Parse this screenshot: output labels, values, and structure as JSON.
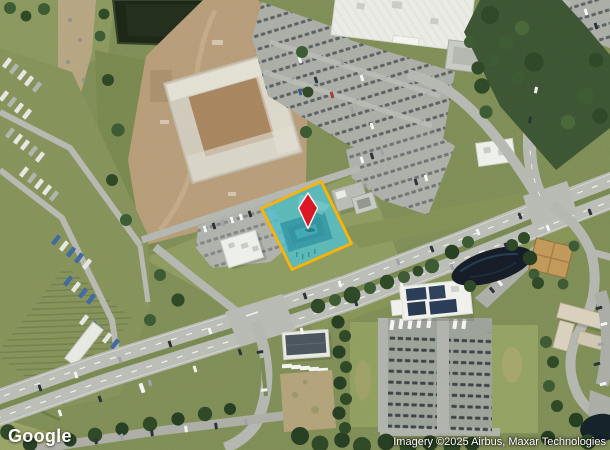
{
  "map": {
    "view_type": "satellite",
    "watermark": "Google",
    "attribution": "Imagery ©2025 Airbus, Maxar Technologies",
    "parcel": {
      "fill_color": "#4DBECB",
      "border_color": "#FFB000"
    },
    "pin": {
      "shape": "diamond",
      "color": "#DC1620"
    }
  }
}
